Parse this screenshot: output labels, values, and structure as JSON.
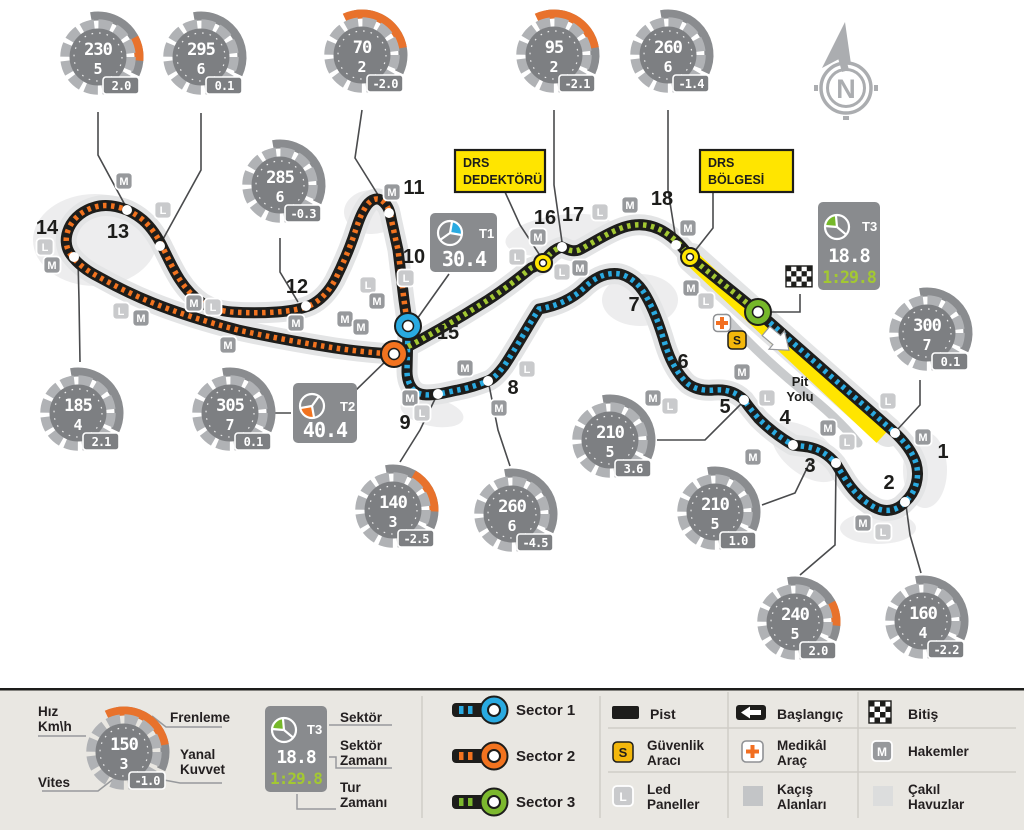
{
  "colors": {
    "sector1": "#29aae1",
    "sector2": "#f2731f",
    "sector3_dash": "#a3c832",
    "sector3_ring": "#76b82a",
    "drs_yellow": "#ffe500",
    "brake_orange": "#e8722c",
    "track": "#1d1d1b",
    "gauge_disc": "#7d7f82",
    "badge_m": "#97999c",
    "badge_l": "#c9cacc",
    "safety_yellow": "#f3b70b",
    "medical_orange": "#f26f21"
  },
  "map": {
    "t1": {
      "label": "T1",
      "time": "30.4"
    },
    "t2": {
      "label": "T2",
      "time": "40.4"
    },
    "t3": {
      "label": "T3",
      "time": "18.8",
      "lap": "1:29.8"
    },
    "drs_detector": {
      "line1": "DRS",
      "line2": "DEDEKTÖRÜ"
    },
    "drs_zone": {
      "line1": "DRS",
      "line2": "BÖLGESİ"
    },
    "pit": {
      "line1": "Pit",
      "line2": "Yolu"
    },
    "compass": {
      "letter": "N"
    },
    "gauges": [
      {
        "x": 98,
        "y": 57,
        "s": "230",
        "g": "5",
        "f": "2.0",
        "a": "small"
      },
      {
        "x": 201,
        "y": 57,
        "s": "295",
        "g": "6",
        "f": "0.1",
        "a": "none"
      },
      {
        "x": 362,
        "y": 55,
        "s": "70",
        "g": "2",
        "f": "-2.0",
        "a": "big"
      },
      {
        "x": 554,
        "y": 55,
        "s": "95",
        "g": "2",
        "f": "-2.1",
        "a": "big"
      },
      {
        "x": 668,
        "y": 55,
        "s": "260",
        "g": "6",
        "f": "-1.4",
        "a": "none"
      },
      {
        "x": 280,
        "y": 185,
        "s": "285",
        "g": "6",
        "f": "-0.3",
        "a": "none"
      },
      {
        "x": 927,
        "y": 333,
        "s": "300",
        "g": "7",
        "f": "0.1",
        "a": "none"
      },
      {
        "x": 78,
        "y": 413,
        "s": "185",
        "g": "4",
        "f": "2.1",
        "a": "none"
      },
      {
        "x": 230,
        "y": 413,
        "s": "305",
        "g": "7",
        "f": "0.1",
        "a": "none"
      },
      {
        "x": 393,
        "y": 510,
        "s": "140",
        "g": "3",
        "f": "-2.5",
        "a": "mid"
      },
      {
        "x": 512,
        "y": 514,
        "s": "260",
        "g": "6",
        "f": "-4.5",
        "a": "none"
      },
      {
        "x": 610,
        "y": 440,
        "s": "210",
        "g": "5",
        "f": "3.6",
        "a": "none"
      },
      {
        "x": 715,
        "y": 512,
        "s": "210",
        "g": "5",
        "f": "1.0",
        "a": "none"
      },
      {
        "x": 795,
        "y": 622,
        "s": "240",
        "g": "5",
        "f": "2.0",
        "a": "small"
      },
      {
        "x": 923,
        "y": 621,
        "s": "160",
        "g": "4",
        "f": "-2.2",
        "a": "none"
      }
    ],
    "corners": [
      [
        "1",
        943,
        452
      ],
      [
        "2",
        889,
        483
      ],
      [
        "3",
        810,
        466
      ],
      [
        "4",
        785,
        418
      ],
      [
        "5",
        725,
        407
      ],
      [
        "6",
        683,
        362
      ],
      [
        "7",
        634,
        305
      ],
      [
        "8",
        513,
        388
      ],
      [
        "9",
        405,
        423
      ],
      [
        "10",
        414,
        257
      ],
      [
        "11",
        414,
        188
      ],
      [
        "12",
        297,
        287
      ],
      [
        "13",
        118,
        232
      ],
      [
        "14",
        47,
        228
      ],
      [
        "15",
        448,
        333
      ],
      [
        "16",
        545,
        218
      ],
      [
        "17",
        573,
        215
      ],
      [
        "18",
        662,
        199
      ]
    ],
    "dots": [
      [
        127,
        210
      ],
      [
        160,
        246
      ],
      [
        74,
        257
      ],
      [
        306,
        306
      ],
      [
        389,
        213
      ],
      [
        438,
        394
      ],
      [
        488,
        381
      ],
      [
        562,
        247
      ],
      [
        676,
        245
      ],
      [
        895,
        433
      ],
      [
        905,
        502
      ],
      [
        836,
        463
      ],
      [
        793,
        445
      ],
      [
        744,
        400
      ]
    ],
    "sector_markers": [
      [
        408,
        326,
        "sector1"
      ],
      [
        394,
        354,
        "sector2"
      ],
      [
        758,
        312,
        "sector3_ring"
      ]
    ],
    "drs_markers": [
      [
        543,
        263
      ],
      [
        690,
        257
      ]
    ],
    "badges": [
      [
        "M",
        392,
        192
      ],
      [
        "L",
        406,
        278
      ],
      [
        "L",
        368,
        285
      ],
      [
        "M",
        377,
        301
      ],
      [
        "M",
        345,
        319
      ],
      [
        "M",
        361,
        327
      ],
      [
        "M",
        124,
        181
      ],
      [
        "L",
        163,
        210
      ],
      [
        "L",
        45,
        247
      ],
      [
        "M",
        52,
        265
      ],
      [
        "L",
        121,
        311
      ],
      [
        "M",
        141,
        318
      ],
      [
        "M",
        194,
        303
      ],
      [
        "L",
        213,
        307
      ],
      [
        "M",
        296,
        323
      ],
      [
        "M",
        228,
        345
      ],
      [
        "M",
        410,
        398
      ],
      [
        "L",
        422,
        413
      ],
      [
        "M",
        465,
        368
      ],
      [
        "L",
        527,
        369
      ],
      [
        "M",
        499,
        408
      ],
      [
        "L",
        517,
        257
      ],
      [
        "M",
        538,
        237
      ],
      [
        "L",
        562,
        272
      ],
      [
        "M",
        580,
        268
      ],
      [
        "L",
        600,
        212
      ],
      [
        "M",
        630,
        205
      ],
      [
        "M",
        688,
        228
      ],
      [
        "M",
        691,
        288
      ],
      [
        "L",
        706,
        301
      ],
      [
        "M",
        742,
        372
      ],
      [
        "L",
        767,
        398
      ],
      [
        "M",
        828,
        428
      ],
      [
        "L",
        847,
        442
      ],
      [
        "L",
        888,
        401
      ],
      [
        "M",
        923,
        437
      ],
      [
        "M",
        863,
        523
      ],
      [
        "L",
        883,
        532
      ],
      [
        "M",
        653,
        398
      ],
      [
        "L",
        670,
        406
      ],
      [
        "M",
        753,
        457
      ],
      [
        "S",
        737,
        340
      ],
      [
        "+",
        722,
        323
      ]
    ]
  },
  "legend": {
    "gauge": {
      "x": 124,
      "y": 752,
      "s": "150",
      "g": "3",
      "f": "-1.0",
      "a": "big"
    },
    "gauge_labels": {
      "speed1": "Hız",
      "speed2": "Km\\h",
      "gear": "Vites",
      "brake": "Frenleme",
      "lateral1": "Yanal",
      "lateral2": "Kuvvet"
    },
    "box_labels": {
      "sector": "Sektör",
      "sector_time1": "Sektör",
      "sector_time2": "Zamanı",
      "lap_time1": "Tur",
      "lap_time2": "Zamanı"
    },
    "sectors": [
      {
        "label": "Sector 1",
        "color": "#29aae1"
      },
      {
        "label": "Sector 2",
        "color": "#f2731f"
      },
      {
        "label": "Sector 3",
        "color": "#7cb82e"
      }
    ],
    "items": {
      "track": "Pist",
      "start": "Başlangıç",
      "finish": "Bitiş",
      "safety1": "Güvenlik",
      "safety2": "Aracı",
      "medical1": "Medikâl",
      "medical2": "Araç",
      "marshals": "Hakemler",
      "led1": "Led",
      "led2": "Paneller",
      "runoff1": "Kaçış",
      "runoff2": "Alanları",
      "gravel1": "Çakıl",
      "gravel2": "Havuzlar"
    }
  }
}
